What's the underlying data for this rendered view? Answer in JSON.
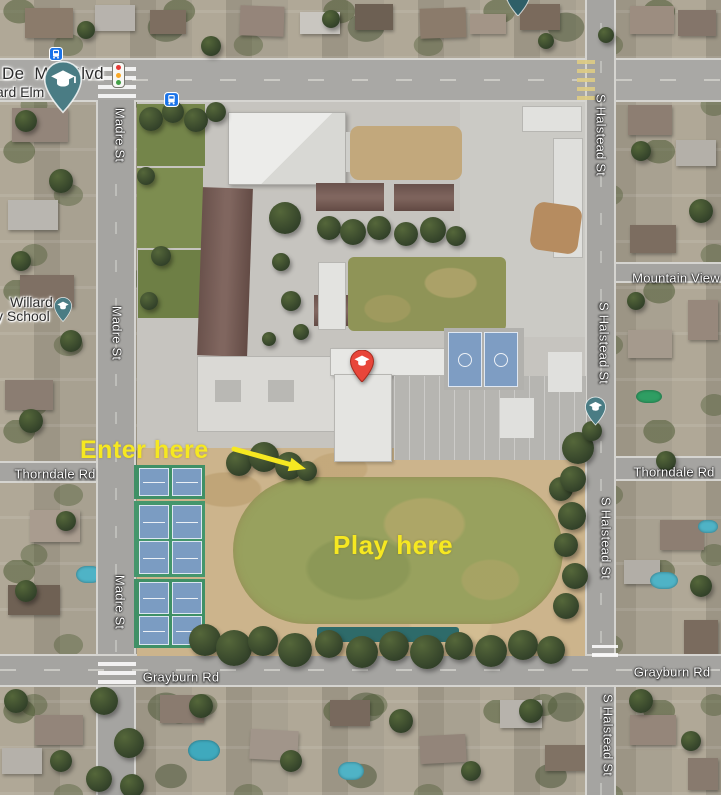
{
  "labels": {
    "del_mar_blvd": "De  Mar Blvd",
    "willard_elm_partial": "ard Elm",
    "willard_line1": "Willard",
    "willard_line2": "y School",
    "madre_st": "Madre St",
    "s_halstead_st": "S Halstead St",
    "thorndale_rd": "Thorndale Rd",
    "grayburn_rd": "Grayburn Rd",
    "mountain_view": "Mountain View",
    "wilson_line1": "Wilson",
    "wilson_line2": "Middle School"
  },
  "annotations": {
    "enter_here": "Enter here",
    "play_here": "Play here",
    "highlight_color": "#f6e821"
  },
  "icons": {
    "school_pin_color": "#4a7c84",
    "school_pin_dark_color": "#2f5f68",
    "wilson_pin_color": "#e8463a",
    "bus_icon_color": "#1a73e8",
    "traffic_light_red": "#e53935",
    "traffic_light_yellow": "#f9a825",
    "traffic_light_green": "#43a047"
  }
}
